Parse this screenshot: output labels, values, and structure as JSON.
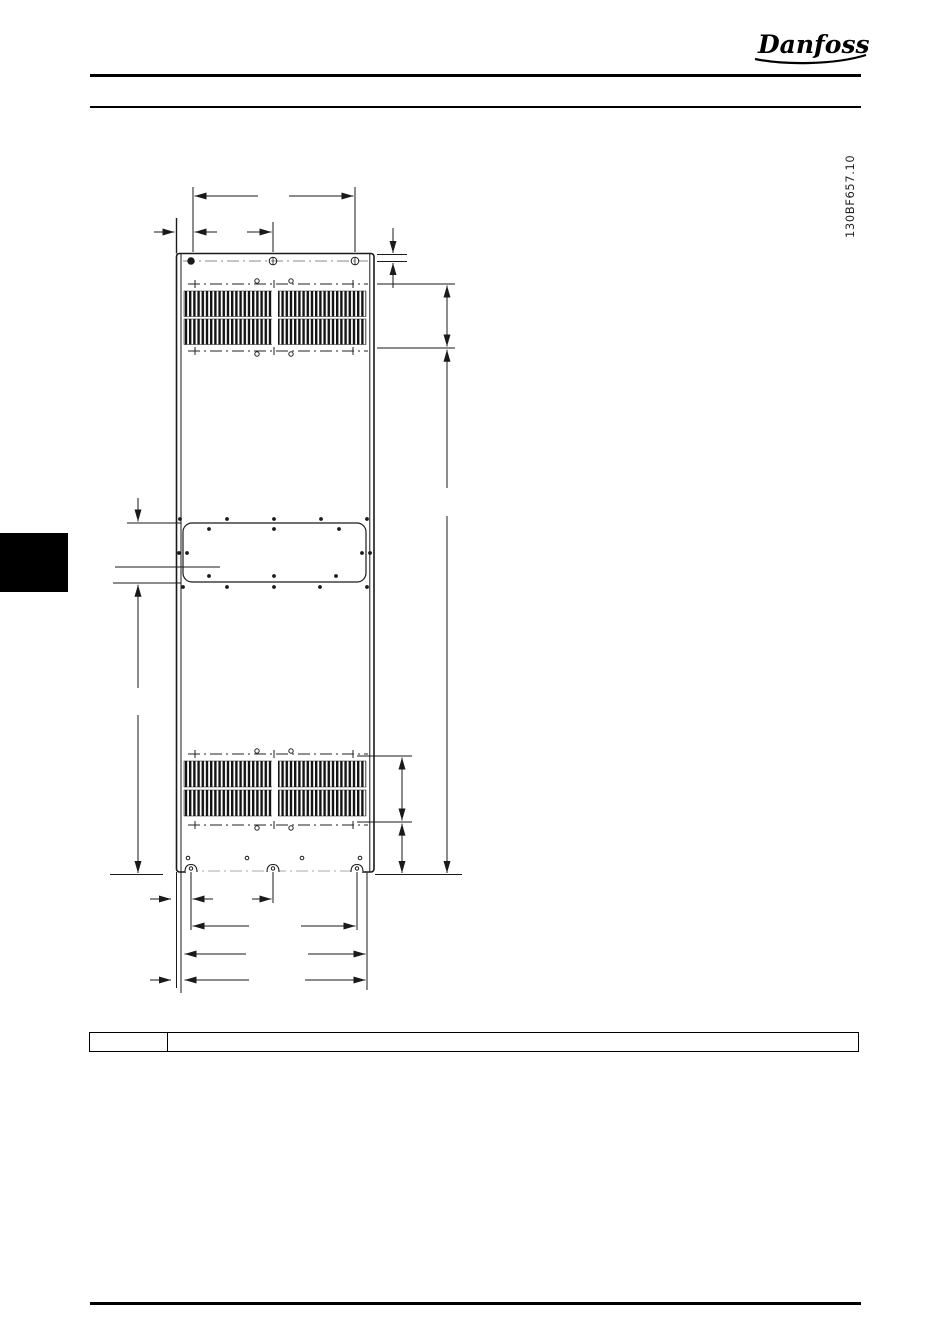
{
  "header": {
    "logo_text": "Danfoss"
  },
  "figure": {
    "reference_code": "130BF657.10"
  },
  "footnote_table": {
    "left_cell": "",
    "right_cell": ""
  },
  "page": {
    "background": "#ffffff",
    "line_color": "#1a1a1a",
    "tab_color": "#000000"
  }
}
